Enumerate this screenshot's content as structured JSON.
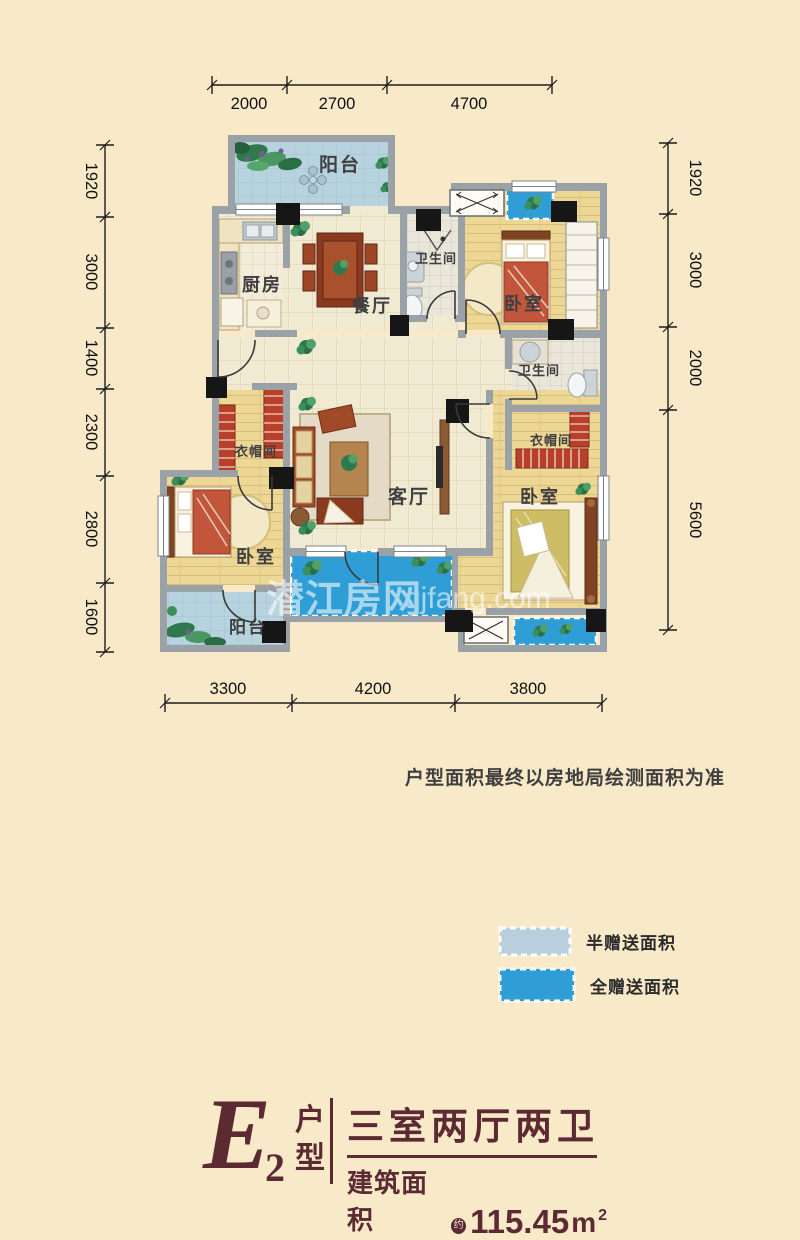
{
  "plan": {
    "rooms": [
      {
        "name": "balcony-top",
        "label": "阳台"
      },
      {
        "name": "kitchen",
        "label": "厨房"
      },
      {
        "name": "dining-room",
        "label": "餐厅"
      },
      {
        "name": "bathroom-top",
        "label": "卫生间"
      },
      {
        "name": "bedroom-top-right",
        "label": "卧室"
      },
      {
        "name": "bathroom-right",
        "label": "卫生间"
      },
      {
        "name": "closet-right",
        "label": "衣帽间"
      },
      {
        "name": "bedroom-right",
        "label": "卧室"
      },
      {
        "name": "living-room",
        "label": "客厅"
      },
      {
        "name": "closet-left",
        "label": "衣帽间"
      },
      {
        "name": "bedroom-left",
        "label": "卧室"
      },
      {
        "name": "balcony-bottom",
        "label": "阳台"
      }
    ],
    "dims": {
      "top": [
        "2000",
        "2700",
        "4700"
      ],
      "bottom": [
        "3300",
        "4200",
        "3800"
      ],
      "left": [
        "1920",
        "3000",
        "1400",
        "2300",
        "2800",
        "1600"
      ],
      "right": [
        "1920",
        "3000",
        "2000",
        "5600"
      ]
    }
  },
  "watermark": {
    "brand": "潜江房网",
    "site": "qjfang.com"
  },
  "disclaimer": "户型面积最终以房地局绘测面积为准",
  "legend": [
    {
      "label": "半赠送面积",
      "color": "#b9cfdd"
    },
    {
      "label": "全赠送面积",
      "color": "#2f9ed6"
    }
  ],
  "title": {
    "letter": "E",
    "sub": "2",
    "type_top": "户",
    "type_bottom": "型",
    "layout": "三室两厅两卫",
    "area_label": "建筑面积",
    "approx": "约",
    "area": "115.45",
    "unit": "m",
    "sup": "2",
    "color": "#5b2a33"
  }
}
